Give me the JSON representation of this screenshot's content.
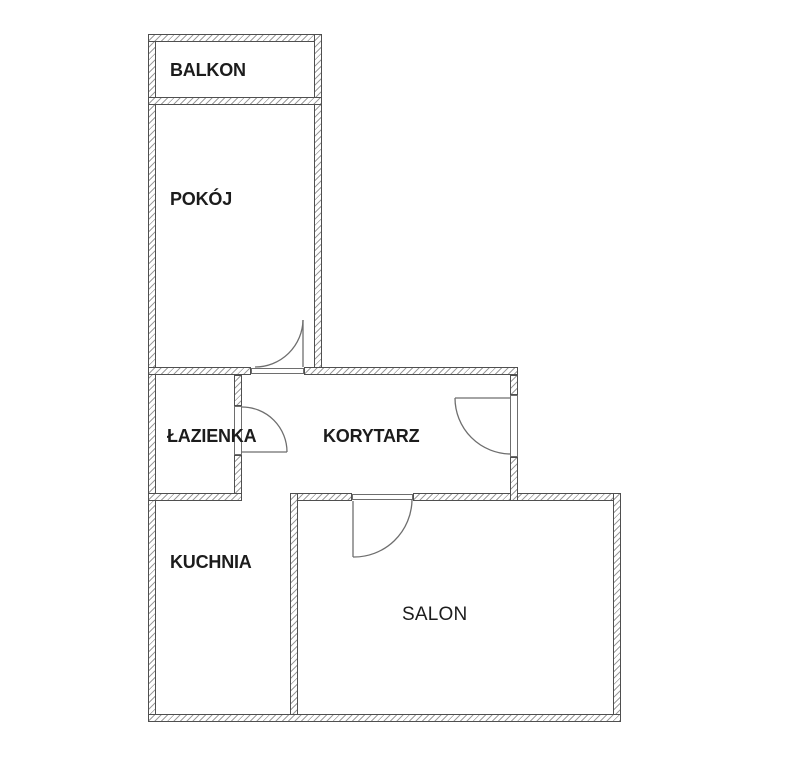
{
  "rooms": [
    {
      "name": "balkon",
      "label": "BALKON"
    },
    {
      "name": "pokoj",
      "label": "POKÓJ"
    },
    {
      "name": "lazienka",
      "label": "ŁAZIENKA"
    },
    {
      "name": "korytarz",
      "label": "KORYTARZ"
    },
    {
      "name": "kuchnia",
      "label": "KUCHNIA"
    },
    {
      "name": "salon",
      "label": "SALON"
    }
  ],
  "colors": {
    "background": "#ffffff",
    "wall-outline": "#4f4f4f",
    "wall-hatch": "#9c9c9c",
    "door-line": "#6e6e6e",
    "label": "#1c1c1c"
  }
}
